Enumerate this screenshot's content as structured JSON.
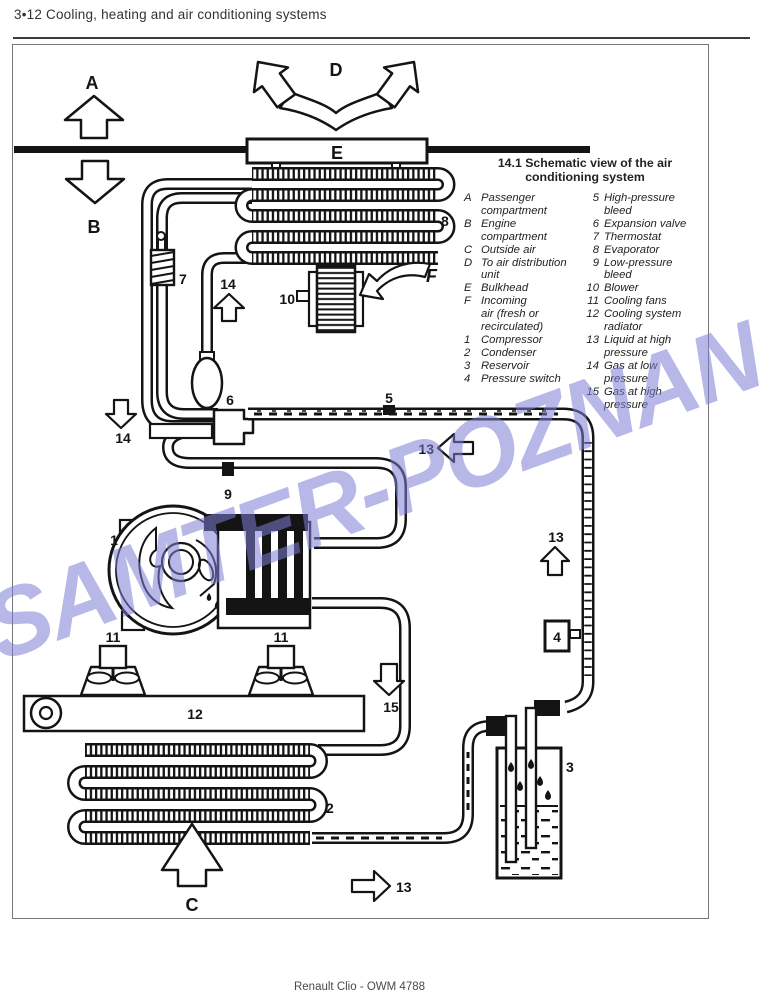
{
  "page": {
    "header": "3•12  Cooling, heating and air conditioning systems",
    "footer": "Renault Clio - OWM 4788",
    "watermark": "SAMTER-POZNAN"
  },
  "figure": {
    "title_line1": "14.1  Schematic view of the air",
    "title_line2": "conditioning system",
    "legend_left": [
      {
        "key": "A",
        "label": "Passenger\ncompartment"
      },
      {
        "key": "B",
        "label": "Engine\ncompartment"
      },
      {
        "key": "C",
        "label": "Outside air"
      },
      {
        "key": "D",
        "label": "To air distribution\nunit"
      },
      {
        "key": "E",
        "label": "Bulkhead"
      },
      {
        "key": "F",
        "label": "Incoming\nair (fresh or\nrecirculated)"
      },
      {
        "key": "1",
        "label": "Compressor"
      },
      {
        "key": "2",
        "label": "Condenser"
      },
      {
        "key": "3",
        "label": "Reservoir"
      },
      {
        "key": "4",
        "label": "Pressure switch"
      }
    ],
    "legend_right": [
      {
        "key": "5",
        "label": "High-pressure\nbleed"
      },
      {
        "key": "6",
        "label": "Expansion valve"
      },
      {
        "key": "7",
        "label": "Thermostat"
      },
      {
        "key": "8",
        "label": "Evaporator"
      },
      {
        "key": "9",
        "label": "Low-pressure\nbleed"
      },
      {
        "key": "10",
        "label": "Blower"
      },
      {
        "key": "11",
        "label": "Cooling fans"
      },
      {
        "key": "12",
        "label": "Cooling system\nradiator"
      },
      {
        "key": "13",
        "label": "Liquid at high\npressure"
      },
      {
        "key": "14",
        "label": "Gas at low\npressure"
      },
      {
        "key": "15",
        "label": "Gas at high\npressure"
      }
    ]
  },
  "callouts": {
    "A": "A",
    "B": "B",
    "C": "C",
    "D": "D",
    "E": "E",
    "F": "F",
    "1": "1",
    "2": "2",
    "3": "3",
    "4": "4",
    "5": "5",
    "6": "6",
    "7": "7",
    "8": "8",
    "9": "9",
    "10": "10",
    "11": "11",
    "12": "12",
    "13": "13",
    "14": "14",
    "15": "15"
  }
}
